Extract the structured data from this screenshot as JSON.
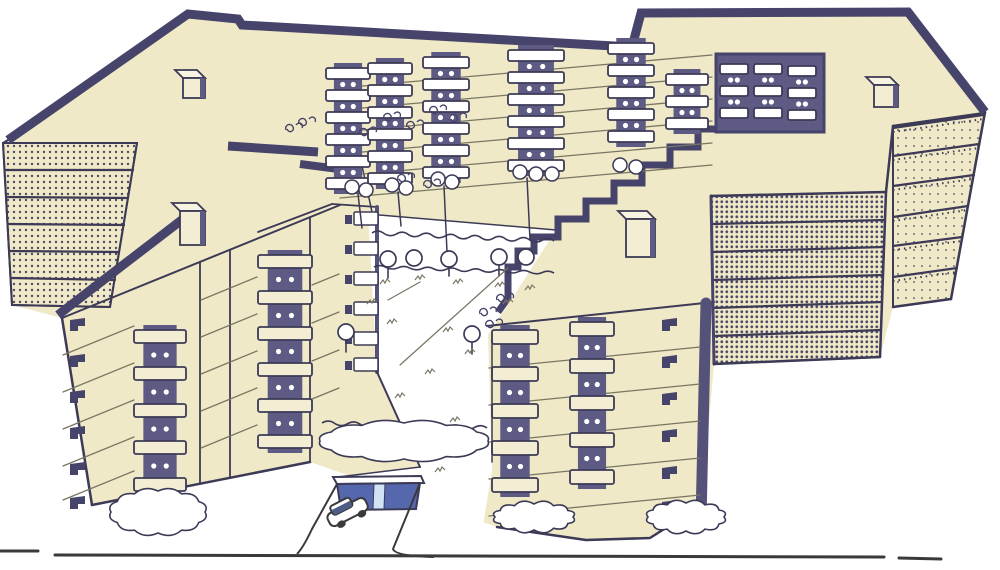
{
  "scene": {
    "title": "Apartment complex - axonometric drawing",
    "subject": "Hand-drawn aerial axonometric illustration of a multi-wing apartment housing complex with stacked balconies, stippled end walls, rooftop vents, inner courtyard with trees and hedges, underground garage entrance with a car, and a street line in the foreground",
    "style": "ink line drawing with cream wash and dark blue shading",
    "floors": 6,
    "rooftop_units_count": 4,
    "car_count": 1
  },
  "colors": {
    "paper": "#ffffff",
    "cream": "#F0E9C7",
    "cream_light": "#F3EDD3",
    "cream_top": "#F8F4E2",
    "ink": "#47446B",
    "ink_soft": "#55527A",
    "shadow": "#5D5A83",
    "outline": "#3C3A56",
    "line": "#787663",
    "dots": "#4E4B68",
    "ground": "#3A3A3C",
    "garage_door": "#5568AE",
    "garage_pillar": "#D0E2F3",
    "car_window": "#4C5C85",
    "white": "#ffffff"
  },
  "drawing": {
    "canvas": {
      "w": 1000,
      "h": 570
    },
    "mass_outline": "188,14 244,21 632,47 641,13 908,12 985,112 951,299 893,307 880,357 714,364 702,505 650,538 586,540 497,527 310,462 92,505 62,318 12,305 3,143",
    "courtyard_cut": "368,214 556,230 506,308 488,334 492,470 478,556 298,556 312,528 338,477 420,467 377,372",
    "stipple_walls": [
      {
        "pts": "3,143 137,143 110,307 12,305",
        "pattern": "dotsMid"
      },
      {
        "pts": "711,196 886,192 880,357 714,364",
        "pattern": "dotsDense"
      },
      {
        "pts": "893,126 985,113 951,299 893,307",
        "pattern": "dotsLight"
      }
    ],
    "wall_dividers": [
      {
        "l": [
          5,
          170,
          133,
          170
        ],
        "t": 0
      },
      {
        "l": [
          6,
          197,
          128,
          198
        ],
        "t": 0
      },
      {
        "l": [
          8,
          224,
          124,
          225
        ],
        "t": 0
      },
      {
        "l": [
          9,
          251,
          119,
          252
        ],
        "t": 0
      },
      {
        "l": [
          11,
          278,
          115,
          280
        ],
        "t": 0
      },
      {
        "l": [
          712,
          224,
          885,
          220
        ],
        "t": 0
      },
      {
        "l": [
          712,
          252,
          884,
          247
        ],
        "t": 0
      },
      {
        "l": [
          713,
          280,
          883,
          275
        ],
        "t": 0
      },
      {
        "l": [
          713,
          308,
          882,
          302
        ],
        "t": 0
      },
      {
        "l": [
          714,
          336,
          881,
          330
        ],
        "t": 0
      },
      {
        "l": [
          893,
          156,
          979,
          144
        ],
        "t": 1
      },
      {
        "l": [
          893,
          186,
          974,
          175
        ],
        "t": 1
      },
      {
        "l": [
          893,
          217,
          968,
          206
        ],
        "t": 1
      },
      {
        "l": [
          893,
          246,
          962,
          237
        ],
        "t": 1
      },
      {
        "l": [
          893,
          277,
          957,
          268
        ],
        "t": 1
      },
      {
        "l": [
          893,
          128,
          983,
          115
        ],
        "t": 1
      }
    ],
    "bands": [
      {
        "p": "8,140 188,14 238,19 242,25 632,47 641,13 908,12 985,112",
        "w": 9
      },
      {
        "p": "58,315 196,209",
        "w": 9
      },
      {
        "p": "228,146 318,152",
        "w": 9
      },
      {
        "p": "300,164 362,172",
        "w": 8
      },
      {
        "p": "716,129 698,129 698,147 670,147 670,165 642,165 642,183 614,183 614,201 586,201 586,219 558,219 558,237 534,237 534,251 518,251 518,267 508,267 508,298 498,312",
        "w": 7
      }
    ],
    "edges": [
      {
        "p": "8,140 3,143 12,305",
        "w": 2
      },
      {
        "p": "12,305 110,307",
        "w": 2
      },
      {
        "p": "137,143 110,307",
        "w": 2
      },
      {
        "p": "3,143 137,143",
        "w": 2
      },
      {
        "p": "62,318 92,505",
        "w": 2.5
      },
      {
        "p": "92,505 310,462",
        "w": 2.5
      },
      {
        "p": "62,318 340,205",
        "w": 2
      },
      {
        "p": "200,262 200,483",
        "w": 1.8
      },
      {
        "p": "230,250 230,477",
        "w": 1.8
      },
      {
        "p": "310,217 310,462",
        "w": 1.8
      },
      {
        "p": "258,232 332,204",
        "w": 1.8
      },
      {
        "p": "332,204 377,207",
        "w": 1.8
      },
      {
        "p": "377,207 377,372",
        "w": 4,
        "c": "ink_soft"
      },
      {
        "p": "377,372 420,467",
        "w": 2
      },
      {
        "p": "420,467 338,477",
        "w": 1.5
      },
      {
        "p": "368,214 556,230",
        "w": 1.5
      },
      {
        "p": "487,326 714,302",
        "w": 2
      },
      {
        "p": "706,303 701,520",
        "w": 11,
        "c": "ink_soft"
      },
      {
        "p": "497,527 586,540",
        "w": 2.5
      },
      {
        "p": "586,540 650,538 702,505",
        "w": 2.5
      },
      {
        "p": "711,196 714,364",
        "w": 3,
        "c": "ink"
      },
      {
        "p": "714,364 880,357",
        "w": 2.5
      },
      {
        "p": "880,357 886,192",
        "w": 2.5
      },
      {
        "p": "711,196 886,192",
        "w": 2.5
      },
      {
        "p": "886,192 893,126",
        "w": 2.5
      },
      {
        "p": "893,126 985,113",
        "w": 2.5
      },
      {
        "p": "985,112 951,299",
        "w": 2.5
      },
      {
        "p": "951,299 893,307",
        "w": 2.5
      },
      {
        "p": "893,126 893,307",
        "w": 2
      },
      {
        "p": "340,64 372,212",
        "w": 1.5
      }
    ],
    "floor_lines": [
      {
        "x1": 340,
        "x2": 712,
        "dy": -33,
        "ys": [
          88,
          110,
          132,
          154,
          176,
          198
        ]
      },
      {
        "x1": 489,
        "x2": 700,
        "dy": -21,
        "ys": [
          368,
          405,
          442,
          479,
          516
        ]
      },
      {
        "x1": 63,
        "x2": 134,
        "dy": -29,
        "ys": [
          355,
          392,
          429,
          466,
          500
        ]
      },
      {
        "x1": 201,
        "x2": 257,
        "dy": -23,
        "ys": [
          300,
          337,
          374,
          411,
          448
        ]
      },
      {
        "x1": 312,
        "x2": 339,
        "dy": -11,
        "ys": [
          285,
          323,
          361,
          399
        ]
      }
    ],
    "recess": {
      "x": 716,
      "y": 54,
      "w": 108,
      "h": 78
    },
    "stacks": [
      {
        "x": 326,
        "y": 68,
        "n": 6,
        "w": 44,
        "h": 11,
        "p": 22,
        "f": "white"
      },
      {
        "x": 368,
        "y": 63,
        "n": 6,
        "w": 44,
        "h": 11,
        "p": 22,
        "f": "white"
      },
      {
        "x": 423,
        "y": 57,
        "n": 6,
        "w": 46,
        "h": 11,
        "p": 22,
        "f": "white"
      },
      {
        "x": 508,
        "y": 50,
        "n": 6,
        "w": 56,
        "h": 11,
        "p": 22,
        "f": "white"
      },
      {
        "x": 608,
        "y": 43,
        "n": 5,
        "w": 46,
        "h": 11,
        "p": 22,
        "f": "white"
      },
      {
        "x": 666,
        "y": 74,
        "n": 3,
        "w": 42,
        "h": 11,
        "p": 22,
        "f": "white"
      },
      {
        "x": 720,
        "y": 64,
        "n": 3,
        "w": 28,
        "h": 10,
        "p": 22,
        "f": "white"
      },
      {
        "x": 754,
        "y": 64,
        "n": 3,
        "w": 28,
        "h": 10,
        "p": 22,
        "f": "white"
      },
      {
        "x": 788,
        "y": 66,
        "n": 3,
        "w": 28,
        "h": 10,
        "p": 22,
        "f": "white"
      },
      {
        "x": 134,
        "y": 330,
        "n": 5,
        "w": 52,
        "h": 13,
        "p": 37,
        "f": "cream_light"
      },
      {
        "x": 258,
        "y": 255,
        "n": 6,
        "w": 54,
        "h": 13,
        "p": 36,
        "f": "cream_light"
      },
      {
        "x": 492,
        "y": 330,
        "n": 5,
        "w": 46,
        "h": 14,
        "p": 37,
        "f": "cream_light"
      },
      {
        "x": 570,
        "y": 322,
        "n": 5,
        "w": 44,
        "h": 14,
        "p": 37,
        "f": "cream_light"
      }
    ],
    "flags": [
      {
        "x": 70,
        "ys": [
          320,
          356,
          392,
          428,
          464,
          498
        ]
      },
      {
        "x": 662,
        "ys": [
          320,
          357,
          394,
          431,
          468,
          502
        ]
      }
    ],
    "inner_balconies": {
      "x": 354,
      "w": 24,
      "h": 13,
      "ys": [
        212,
        242,
        272,
        302,
        332,
        358
      ]
    },
    "rooftop_units": [
      {
        "x": 183,
        "y": 78,
        "w": 22,
        "h": 20
      },
      {
        "x": 180,
        "y": 211,
        "w": 25,
        "h": 34
      },
      {
        "x": 626,
        "y": 219,
        "w": 29,
        "h": 38
      },
      {
        "x": 874,
        "y": 85,
        "w": 24,
        "h": 22
      }
    ],
    "bushes": [
      [
        352,
        187
      ],
      [
        366,
        190
      ],
      [
        392,
        185
      ],
      [
        406,
        188
      ],
      [
        438,
        179
      ],
      [
        452,
        182
      ],
      [
        520,
        172
      ],
      [
        536,
        174
      ],
      [
        552,
        174
      ],
      [
        620,
        165
      ],
      [
        636,
        167
      ]
    ],
    "trunks": [
      [
        358,
        194,
        362,
        228
      ],
      [
        398,
        192,
        401,
        226
      ],
      [
        444,
        186,
        447,
        252
      ],
      [
        527,
        178,
        530,
        240
      ],
      [
        492,
        340,
        492,
        462
      ]
    ],
    "trees": [
      [
        388,
        259
      ],
      [
        414,
        258
      ],
      [
        449,
        259
      ],
      [
        499,
        257
      ],
      [
        526,
        257
      ],
      [
        346,
        332
      ],
      [
        472,
        334
      ]
    ],
    "tree_stubs": [
      [
        388,
        267,
        388,
        278
      ],
      [
        449,
        267,
        449,
        276
      ],
      [
        499,
        265,
        499,
        276
      ],
      [
        346,
        340,
        346,
        352
      ],
      [
        472,
        342,
        472,
        354
      ]
    ],
    "hedges": [
      {
        "x1": 372,
        "y1": 233,
        "x2": 554,
        "y2": 241,
        "seg": 15,
        "amp": 4
      },
      {
        "x1": 374,
        "y1": 267,
        "x2": 554,
        "y2": 273,
        "seg": 15,
        "amp": 3
      },
      {
        "x1": 322,
        "y1": 423,
        "x2": 487,
        "y2": 428,
        "seg": 13,
        "amp": 4
      }
    ],
    "path_lines": [
      [
        400,
        365,
        508,
        268
      ],
      [
        388,
        300,
        420,
        282
      ]
    ],
    "tufts": [
      [
        385,
        282
      ],
      [
        420,
        278
      ],
      [
        458,
        282
      ],
      [
        500,
        285
      ],
      [
        530,
        288
      ],
      [
        392,
        322
      ],
      [
        448,
        330
      ],
      [
        470,
        352
      ],
      [
        430,
        372
      ],
      [
        400,
        396
      ],
      [
        455,
        420
      ],
      [
        478,
        442
      ],
      [
        418,
        448
      ],
      [
        372,
        302
      ],
      [
        508,
        302
      ],
      [
        440,
        470
      ]
    ],
    "curls": [
      [
        286,
        130
      ],
      [
        299,
        124
      ],
      [
        360,
        134
      ],
      [
        384,
        119
      ],
      [
        407,
        127
      ],
      [
        430,
        112
      ],
      [
        450,
        120
      ],
      [
        398,
        180
      ],
      [
        424,
        186
      ],
      [
        497,
        300
      ],
      [
        486,
        326
      ],
      [
        480,
        314
      ]
    ],
    "blobs": [
      [
        404,
        441,
        84,
        18
      ],
      [
        158,
        512,
        47,
        21
      ],
      [
        534,
        517,
        39,
        13
      ],
      [
        686,
        517,
        38,
        14
      ]
    ],
    "garage": {
      "lintel": "333,477 421,476 424,483 337,484",
      "door": "337,484 420,483 416,509 341,510",
      "pillar": "374,484 385,484 384,509 373,509",
      "ramp": [
        "M337,484 L312,529 Q303,548 297,554",
        "M420,483 L393,549 Q395,556 434,557"
      ]
    },
    "car": {
      "transform": "translate(323,510) rotate(-27)"
    },
    "ground": [
      [
        0,
        551,
        38,
        551
      ],
      [
        55,
        555,
        884,
        557
      ],
      [
        899,
        558,
        941,
        559
      ]
    ]
  }
}
